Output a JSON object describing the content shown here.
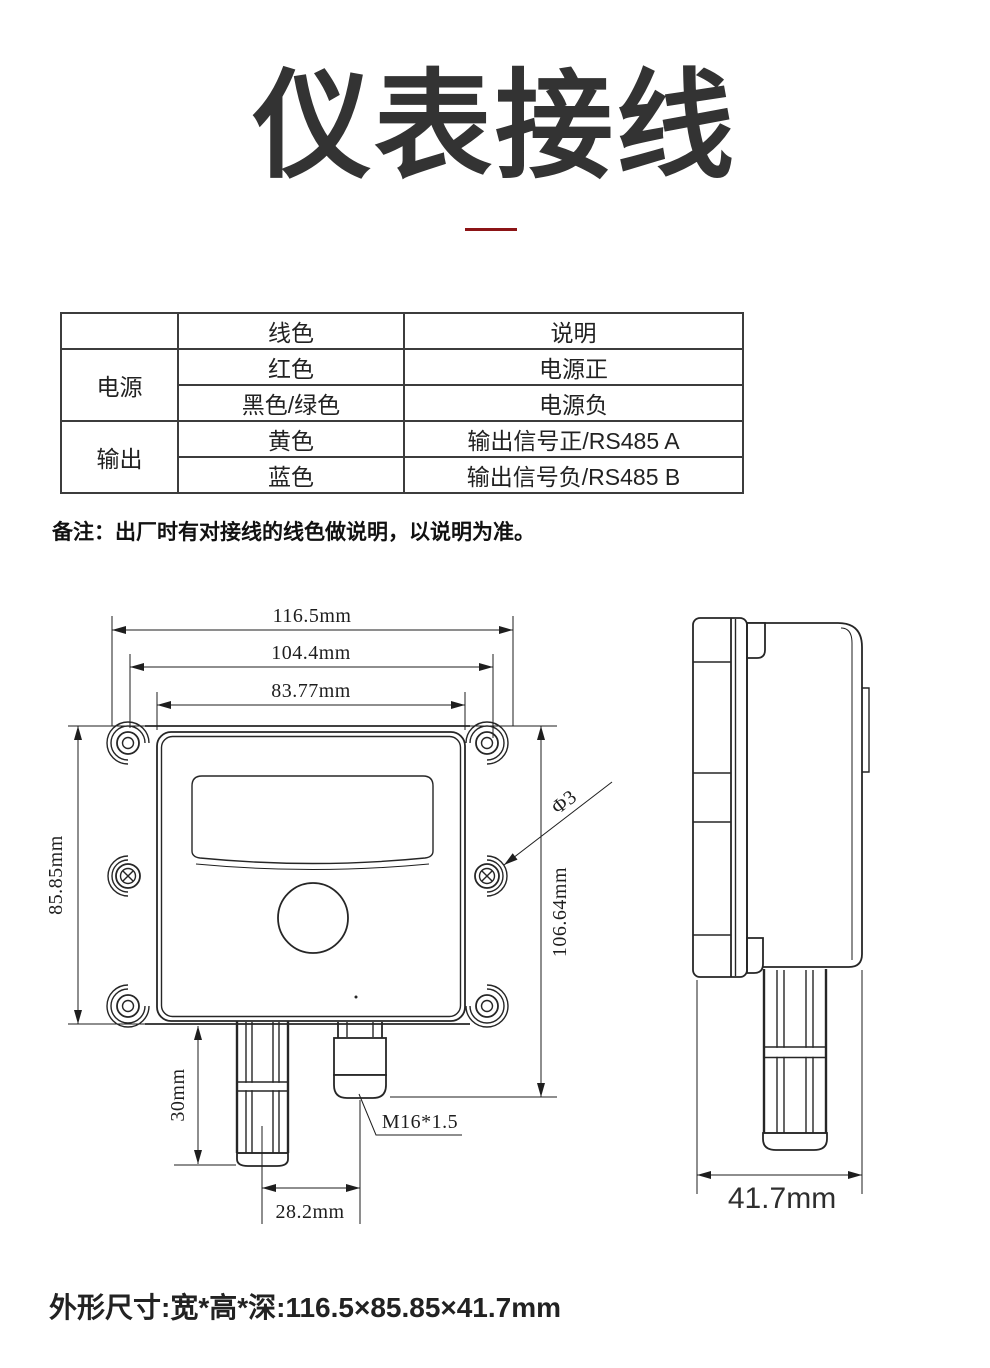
{
  "page": {
    "title": "仪表接线",
    "divider_color": "#8C1416",
    "note": "备注：出厂时有对接线的线色做说明，以说明为准。",
    "footer": "外形尺寸:宽*高*深:116.5×85.85×41.7mm"
  },
  "wiring_table": {
    "headers": [
      "",
      "线色",
      "说明"
    ],
    "groups": [
      {
        "label": "电源",
        "rows": [
          [
            "红色",
            "电源正"
          ],
          [
            "黑色/绿色",
            "电源负"
          ]
        ]
      },
      {
        "label": "输出",
        "rows": [
          [
            "黄色",
            "输出信号正/RS485 A"
          ],
          [
            "蓝色",
            "输出信号负/RS485 B"
          ]
        ]
      }
    ]
  },
  "drawing": {
    "front_view": {
      "dim_width_outer": "116.5mm",
      "dim_width_middle": "104.4mm",
      "dim_width_inner": "83.77mm",
      "dim_height_left": "85.85mm",
      "dim_height_right": "106.64mm",
      "dim_probe_length": "30mm",
      "dim_probe_spacing": "28.2mm",
      "hole_diameter_label": "Φ3",
      "cable_gland_label": "M16*1.5"
    },
    "side_view": {
      "dim_depth": "41.7mm"
    }
  }
}
